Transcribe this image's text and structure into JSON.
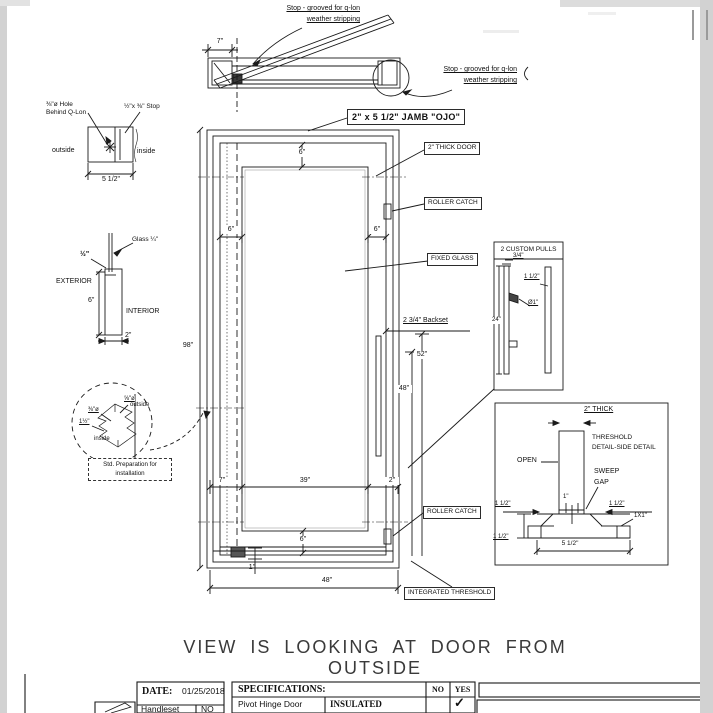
{
  "palette": {
    "line": "#1a1a1a",
    "paper": "#ffffff",
    "chrome_gray": "#d2d2d2"
  },
  "sheet": {
    "top_view": {
      "stop_label_top_1": "Stop - grooved for q-lon",
      "stop_label_top_2": "weather stripping",
      "stop_label_right_1": "Stop - grooved for q-lon",
      "stop_label_right_2": "weather stripping",
      "dim_7": "7\""
    },
    "jamb_callout": "2\" x 5 1/2\" JAMB \"OJO\"",
    "jamb_section": {
      "hole_label_1": "⅜\"ø Hole",
      "hole_label_2": "Behind Q-Lon",
      "stop_label": "½\"x ⅜\" Stop",
      "outside": "outside",
      "inside": "inside",
      "width": "5 1/2\""
    },
    "glass_section": {
      "glass_label": "Glass ¼\"",
      "stop_thickness": "½\"",
      "exterior": "EXTERIOR",
      "interior": "INTERIOR",
      "height": "6\"",
      "width": "2\""
    },
    "pivot_detail": {
      "dia_58": "⅝\"ø",
      "dia_38": "⅜\"ø",
      "dim_112": "1½\"",
      "outside": "outside",
      "inside": "inside",
      "note_1": "Std. Preparation for",
      "note_2": "installation"
    },
    "elevation": {
      "dim_h98": "98\"",
      "dim_top6": "6\"",
      "dim_left6": "6\"",
      "dim_right6": "6\"",
      "dim_52": "52\"",
      "dim_48": "48\"",
      "dim_b7": "7\"",
      "dim_b39": "39\"",
      "dim_b2": "2\"",
      "dim_b6": "6\"",
      "dim_b1": "1\"",
      "dim_w48": "48\""
    },
    "callouts": {
      "thick_door": "2\" THICK DOOR",
      "roller_catch_top": "ROLLER CATCH",
      "fixed_glass": "FIXED GLASS",
      "backset": "2 3/4\" Backset",
      "roller_catch_bottom": "ROLLER CATCH",
      "integrated_threshold": "INTEGRATED THRESHOLD"
    },
    "pulls_detail": {
      "title": "2 CUSTOM PULLS",
      "dim_34": "3/4\"",
      "dim_112": "1 1/2\"",
      "dim_dia1": "Ø1\"",
      "dim_24": "24\""
    },
    "threshold_detail": {
      "thick": "2\" THICK",
      "title_1": "THRESHOLD",
      "title_2": "DETAIL-SIDE DETAIL",
      "open": "OPEN",
      "sweep_1": "SWEEP",
      "sweep_2": "GAP",
      "dim_1": "1\"",
      "dim_left112": "1 1/2\"",
      "dim_right112": "1 1/2\"",
      "dim_1x1": "1X1\"",
      "dim_bl112": "1 1/2\"",
      "dim_base": "5 1/2\""
    },
    "footer": {
      "view_note": "VIEW IS LOOKING AT DOOR FROM OUTSIDE",
      "date_label": "DATE:",
      "date_value": "01/25/2018",
      "handleset_label": "Handleset",
      "handleset_value": "NO",
      "spec_header": "SPECIFICATIONS:",
      "col_no": "NO",
      "col_yes": "YES",
      "spec_row_item": "Pivot Hinge Door",
      "spec_row_feature": "INSULATED",
      "check": "✓"
    }
  }
}
